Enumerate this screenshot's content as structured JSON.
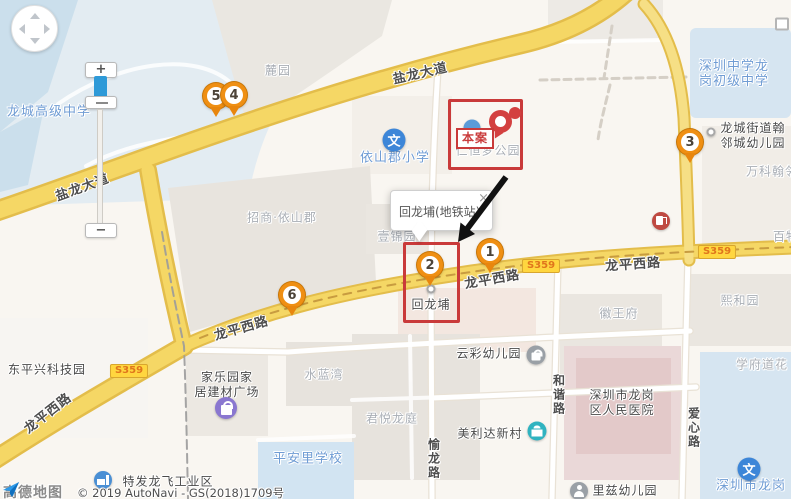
{
  "attribution": {
    "logo": "高德地图",
    "copyright": "© 2019 AutoNavi - GS(2018)1709号"
  },
  "controls": {
    "zoom_in_label": "+",
    "zoom_out_label": "−"
  },
  "infowindow": {
    "text": "回龙埔(地铁站)",
    "close_label": "×"
  },
  "case_tag": {
    "label": "本案"
  },
  "colors": {
    "accent_red": "#c93a3a",
    "marker_orange": "#ef8f13",
    "road_yellow": "#f5d765",
    "school_blue": "#6f9cd4",
    "badge_bg": "#ffd63f",
    "badge_text": "#e0761c"
  },
  "road_badges": [
    {
      "label": "S359",
      "x": 129,
      "y": 371
    },
    {
      "label": "S359",
      "x": 541,
      "y": 266
    },
    {
      "label": "S359",
      "x": 717,
      "y": 252
    }
  ],
  "road_labels": [
    {
      "id": "yanlong-avenue-1",
      "text": "盐龙大道",
      "x": 420,
      "y": 72,
      "rotate": -13
    },
    {
      "id": "yanlong-avenue-2",
      "text": "盐龙大道",
      "x": 82,
      "y": 186,
      "rotate": -20
    },
    {
      "id": "longping-west-road-1",
      "text": "龙平西路",
      "x": 492,
      "y": 278,
      "rotate": -10
    },
    {
      "id": "longping-west-road-2",
      "text": "龙平西路",
      "x": 633,
      "y": 263,
      "rotate": -4
    },
    {
      "id": "longping-west-road-3",
      "text": "龙平西路",
      "x": 241,
      "y": 327,
      "rotate": -16
    },
    {
      "id": "longping-west-road-4",
      "text": "龙平西路",
      "x": 47,
      "y": 412,
      "rotate": -38
    },
    {
      "id": "yulong-road",
      "text": "愉龙路",
      "x": 434,
      "y": 459,
      "vertical": true
    },
    {
      "id": "hexie-road",
      "text": "和谐路",
      "x": 559,
      "y": 395,
      "vertical": true
    },
    {
      "id": "aixin-road",
      "text": "爱心路",
      "x": 694,
      "y": 428,
      "vertical": true
    }
  ],
  "markers": [
    {
      "n": "1",
      "x": 490,
      "y": 252
    },
    {
      "n": "2",
      "x": 430,
      "y": 265
    },
    {
      "n": "3",
      "x": 690,
      "y": 142
    },
    {
      "n": "4",
      "x": 234,
      "y": 95
    },
    {
      "n": "5",
      "x": 216,
      "y": 96,
      "behind": true
    },
    {
      "n": "6",
      "x": 292,
      "y": 295
    }
  ],
  "highlight_boxes": [
    {
      "id": "case-highlight-box",
      "x": 448,
      "y": 99,
      "w": 75,
      "h": 71
    },
    {
      "id": "marker2-highlight-box",
      "x": 403,
      "y": 242,
      "w": 57,
      "h": 81
    }
  ],
  "places": [
    {
      "id": "luyuan",
      "text": "麓园",
      "type": "area",
      "x": 278,
      "y": 71
    },
    {
      "id": "zhaoshang-yishanjun",
      "text": "招商·依山郡",
      "type": "area",
      "x": 282,
      "y": 218
    },
    {
      "id": "yijinyuan",
      "text": "壹锦园",
      "type": "area",
      "x": 397,
      "y": 237
    },
    {
      "id": "renheng-meng-park",
      "text": "仁恒梦公园",
      "type": "area",
      "x": 488,
      "y": 151
    },
    {
      "id": "vanke-hanlin",
      "text": "万科翰邻",
      "type": "area",
      "x": 772,
      "y": 172
    },
    {
      "id": "baiwu-partial",
      "text": "百物",
      "type": "area",
      "x": 786,
      "y": 237
    },
    {
      "id": "shuilanwan",
      "text": "水蓝湾",
      "type": "area",
      "x": 324,
      "y": 375
    },
    {
      "id": "junyue-longting",
      "text": "君悦龙庭",
      "type": "area",
      "x": 392,
      "y": 419
    },
    {
      "id": "huiwangfu",
      "text": "徽王府",
      "type": "area",
      "x": 619,
      "y": 314
    },
    {
      "id": "xiheyuan",
      "text": "熙和园",
      "type": "area",
      "x": 740,
      "y": 301
    },
    {
      "id": "xuefudao-hua",
      "text": "学府道花",
      "type": "area",
      "x": 762,
      "y": 365
    },
    {
      "id": "huilongpu-village",
      "text": "回龙埔",
      "type": "poi",
      "x": 431,
      "y": 305
    },
    {
      "id": "dongpingxing-tech-park",
      "text": "东平兴科技园",
      "type": "poi",
      "x": 47,
      "y": 370
    },
    {
      "id": "jialeyuan-home-mall",
      "lines": [
        "家乐园家",
        "居建材广场"
      ],
      "type": "poi",
      "x": 227,
      "y": 385
    },
    {
      "id": "yuncai-kindergarten",
      "text": "云彩幼儿园",
      "type": "poi",
      "x": 489,
      "y": 354
    },
    {
      "id": "meilida-village",
      "text": "美利达新村",
      "type": "poi",
      "x": 490,
      "y": 434
    },
    {
      "id": "longgang-hospital",
      "lines": [
        "深圳市龙岗",
        "区人民医院"
      ],
      "type": "poi",
      "x": 622,
      "y": 403
    },
    {
      "id": "lizi-kindergarten",
      "text": "里兹幼儿园",
      "type": "poi",
      "x": 625,
      "y": 491
    },
    {
      "id": "hanlin-kindergarten",
      "lines": [
        "龙城街道翰",
        "邻城幼儿园"
      ],
      "type": "poi",
      "x": 753,
      "y": 136
    },
    {
      "id": "tefa-longfei-industrial",
      "text": "特发龙飞工业区",
      "type": "poi",
      "x": 168,
      "y": 482
    },
    {
      "id": "longcheng-high-school",
      "text": "龙城高级中学",
      "type": "school",
      "x": 49,
      "y": 112
    },
    {
      "id": "yishanjun-primary-school",
      "text": "依山郡小学",
      "type": "school",
      "x": 395,
      "y": 158
    },
    {
      "id": "shenzhen-middle-longgang",
      "lines": [
        "深圳中学龙",
        "岗初级中学"
      ],
      "type": "school",
      "x": 734,
      "y": 74
    },
    {
      "id": "pinganli-school",
      "text": "平安里学校",
      "type": "school",
      "x": 308,
      "y": 459
    },
    {
      "id": "longgang-school-bottom",
      "text": "深圳市龙岗",
      "type": "school",
      "x": 751,
      "y": 486
    }
  ],
  "icons": [
    {
      "id": "yishanjun-school-icon",
      "type": "school-icon",
      "glyph": "文",
      "x": 394,
      "y": 140
    },
    {
      "id": "bottom-right-school-icon",
      "type": "school-icon",
      "glyph": "文",
      "x": 749,
      "y": 469
    },
    {
      "id": "gas-station-icon",
      "type": "gas-icon",
      "x": 661,
      "y": 221
    },
    {
      "id": "jialeyuan-shopping-icon",
      "type": "shopping-icon",
      "x": 226,
      "y": 408
    },
    {
      "id": "yuncai-poi-icon",
      "type": "bag-icon",
      "x": 536,
      "y": 355
    },
    {
      "id": "meilida-bank-icon",
      "type": "bank-icon",
      "x": 537,
      "y": 431
    },
    {
      "id": "tefa-factory-icon",
      "type": "factory-icon",
      "x": 103,
      "y": 480
    },
    {
      "id": "lizi-person-icon",
      "type": "person-icon",
      "x": 579,
      "y": 491
    },
    {
      "id": "hanlin-dot-icon",
      "type": "dot-icon",
      "x": 711,
      "y": 132
    },
    {
      "id": "metro-station-dot",
      "type": "dot-icon",
      "x": 431,
      "y": 289
    },
    {
      "id": "park-poi-icon-partial",
      "type": "park-icon",
      "x": 472,
      "y": 128
    },
    {
      "id": "edge-poi-box",
      "type": "box-icon",
      "x": 782,
      "y": 24
    }
  ]
}
